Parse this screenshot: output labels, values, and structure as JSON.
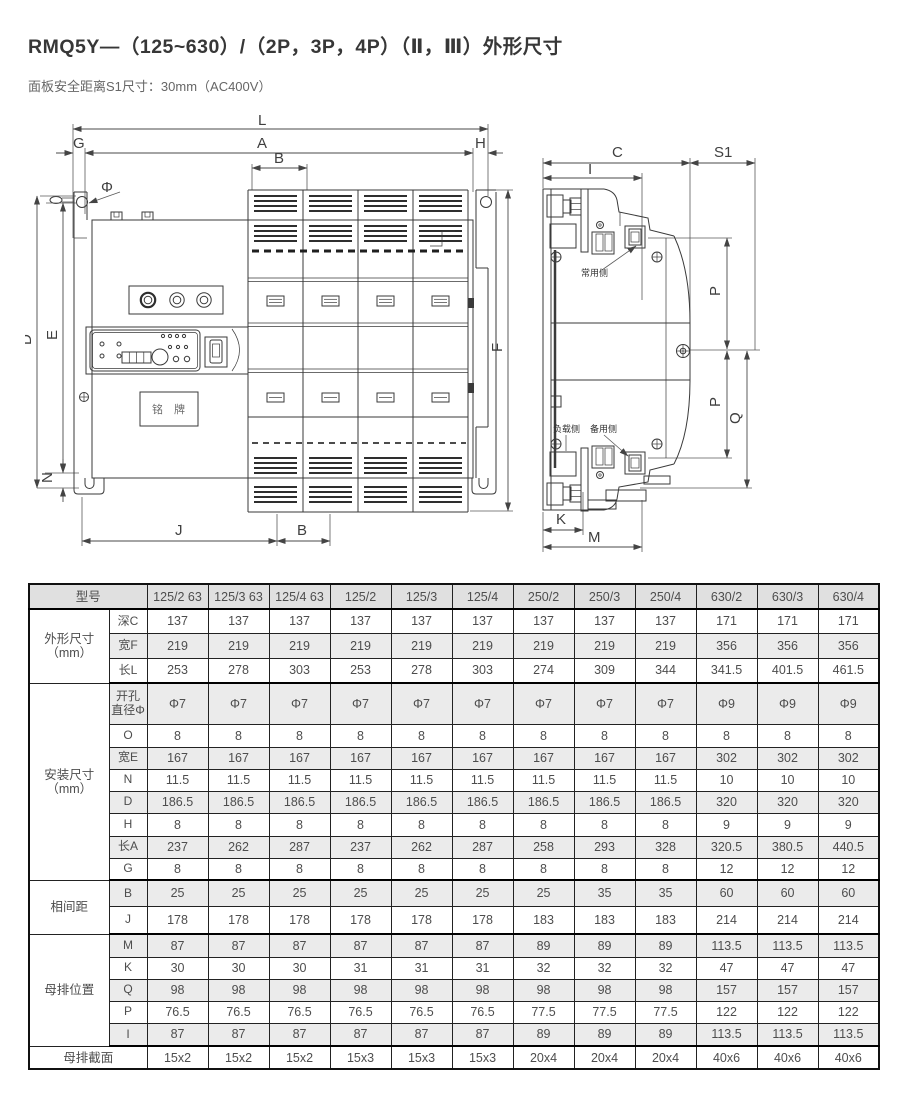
{
  "title": "RMQ5Y—（125~630）/（2P，3P，4P）（Ⅱ，Ⅲ）外形尺寸",
  "subtitle": "面板安全距离S1尺寸：30mm（AC400V）",
  "front_view": {
    "dims": {
      "L": "L",
      "A": "A",
      "B_top": "B",
      "G": "G",
      "H": "H",
      "phi": "Φ",
      "D": "D",
      "E": "E",
      "N": "N",
      "F": "F",
      "J": "J",
      "B_bottom": "B"
    },
    "nameplate": "铭 牌"
  },
  "side_view": {
    "dims": {
      "C": "C",
      "S1": "S1",
      "I": "I",
      "P_upper": "P",
      "P_lower": "P",
      "Q": "Q",
      "K": "K",
      "M": "M"
    },
    "labels": {
      "normal_side": "常用侧",
      "load_side": "负载侧",
      "backup_side": "备用侧"
    }
  },
  "table": {
    "header_label": "型号",
    "columns": [
      "125/2 63",
      "125/3 63",
      "125/4 63",
      "125/2",
      "125/3",
      "125/4",
      "250/2",
      "250/3",
      "250/4",
      "630/2",
      "630/3",
      "630/4"
    ],
    "groups": [
      {
        "label": "外形尺寸（mm）",
        "rows": [
          {
            "name": "深C",
            "values": [
              137,
              137,
              137,
              137,
              137,
              137,
              137,
              137,
              137,
              171,
              171,
              171
            ]
          },
          {
            "name": "宽F",
            "values": [
              219,
              219,
              219,
              219,
              219,
              219,
              219,
              219,
              219,
              356,
              356,
              356
            ]
          },
          {
            "name": "长L",
            "values": [
              253,
              278,
              303,
              253,
              278,
              303,
              274,
              309,
              344,
              341.5,
              401.5,
              461.5
            ]
          }
        ]
      },
      {
        "label": "安装尺寸（mm）",
        "rows": [
          {
            "name": "开孔直径Φ",
            "values": [
              "Φ7",
              "Φ7",
              "Φ7",
              "Φ7",
              "Φ7",
              "Φ7",
              "Φ7",
              "Φ7",
              "Φ7",
              "Φ9",
              "Φ9",
              "Φ9"
            ]
          },
          {
            "name": "O",
            "values": [
              8,
              8,
              8,
              8,
              8,
              8,
              8,
              8,
              8,
              8,
              8,
              8
            ]
          },
          {
            "name": "宽E",
            "values": [
              167,
              167,
              167,
              167,
              167,
              167,
              167,
              167,
              167,
              302,
              302,
              302
            ]
          },
          {
            "name": "N",
            "values": [
              11.5,
              11.5,
              11.5,
              11.5,
              11.5,
              11.5,
              11.5,
              11.5,
              11.5,
              10,
              10,
              10
            ]
          },
          {
            "name": "D",
            "values": [
              186.5,
              186.5,
              186.5,
              186.5,
              186.5,
              186.5,
              186.5,
              186.5,
              186.5,
              320,
              320,
              320
            ]
          },
          {
            "name": "H",
            "values": [
              8,
              8,
              8,
              8,
              8,
              8,
              8,
              8,
              8,
              9,
              9,
              9
            ]
          },
          {
            "name": "长A",
            "values": [
              237,
              262,
              287,
              237,
              262,
              287,
              258,
              293,
              328,
              320.5,
              380.5,
              440.5
            ]
          },
          {
            "name": "G",
            "values": [
              8,
              8,
              8,
              8,
              8,
              8,
              8,
              8,
              8,
              12,
              12,
              12
            ]
          }
        ]
      },
      {
        "label": "相间距",
        "rows": [
          {
            "name": "B",
            "values": [
              25,
              25,
              25,
              25,
              25,
              25,
              25,
              35,
              35,
              60,
              60,
              60
            ]
          },
          {
            "name": "J",
            "values": [
              178,
              178,
              178,
              178,
              178,
              178,
              183,
              183,
              183,
              214,
              214,
              214
            ]
          }
        ]
      },
      {
        "label": "母排位置",
        "rows": [
          {
            "name": "M",
            "values": [
              87,
              87,
              87,
              87,
              87,
              87,
              89,
              89,
              89,
              113.5,
              113.5,
              113.5
            ]
          },
          {
            "name": "K",
            "values": [
              30,
              30,
              30,
              31,
              31,
              31,
              32,
              32,
              32,
              47,
              47,
              47
            ]
          },
          {
            "name": "Q",
            "values": [
              98,
              98,
              98,
              98,
              98,
              98,
              98,
              98,
              98,
              157,
              157,
              157
            ]
          },
          {
            "name": "P",
            "values": [
              76.5,
              76.5,
              76.5,
              76.5,
              76.5,
              76.5,
              77.5,
              77.5,
              77.5,
              122,
              122,
              122
            ]
          },
          {
            "name": "I",
            "values": [
              87,
              87,
              87,
              87,
              87,
              87,
              89,
              89,
              89,
              113.5,
              113.5,
              113.5
            ]
          }
        ]
      }
    ],
    "footer": {
      "label": "母排截面",
      "values": [
        "15x2",
        "15x2",
        "15x2",
        "15x3",
        "15x3",
        "15x3",
        "20x4",
        "20x4",
        "20x4",
        "40x6",
        "40x6",
        "40x6"
      ]
    }
  }
}
